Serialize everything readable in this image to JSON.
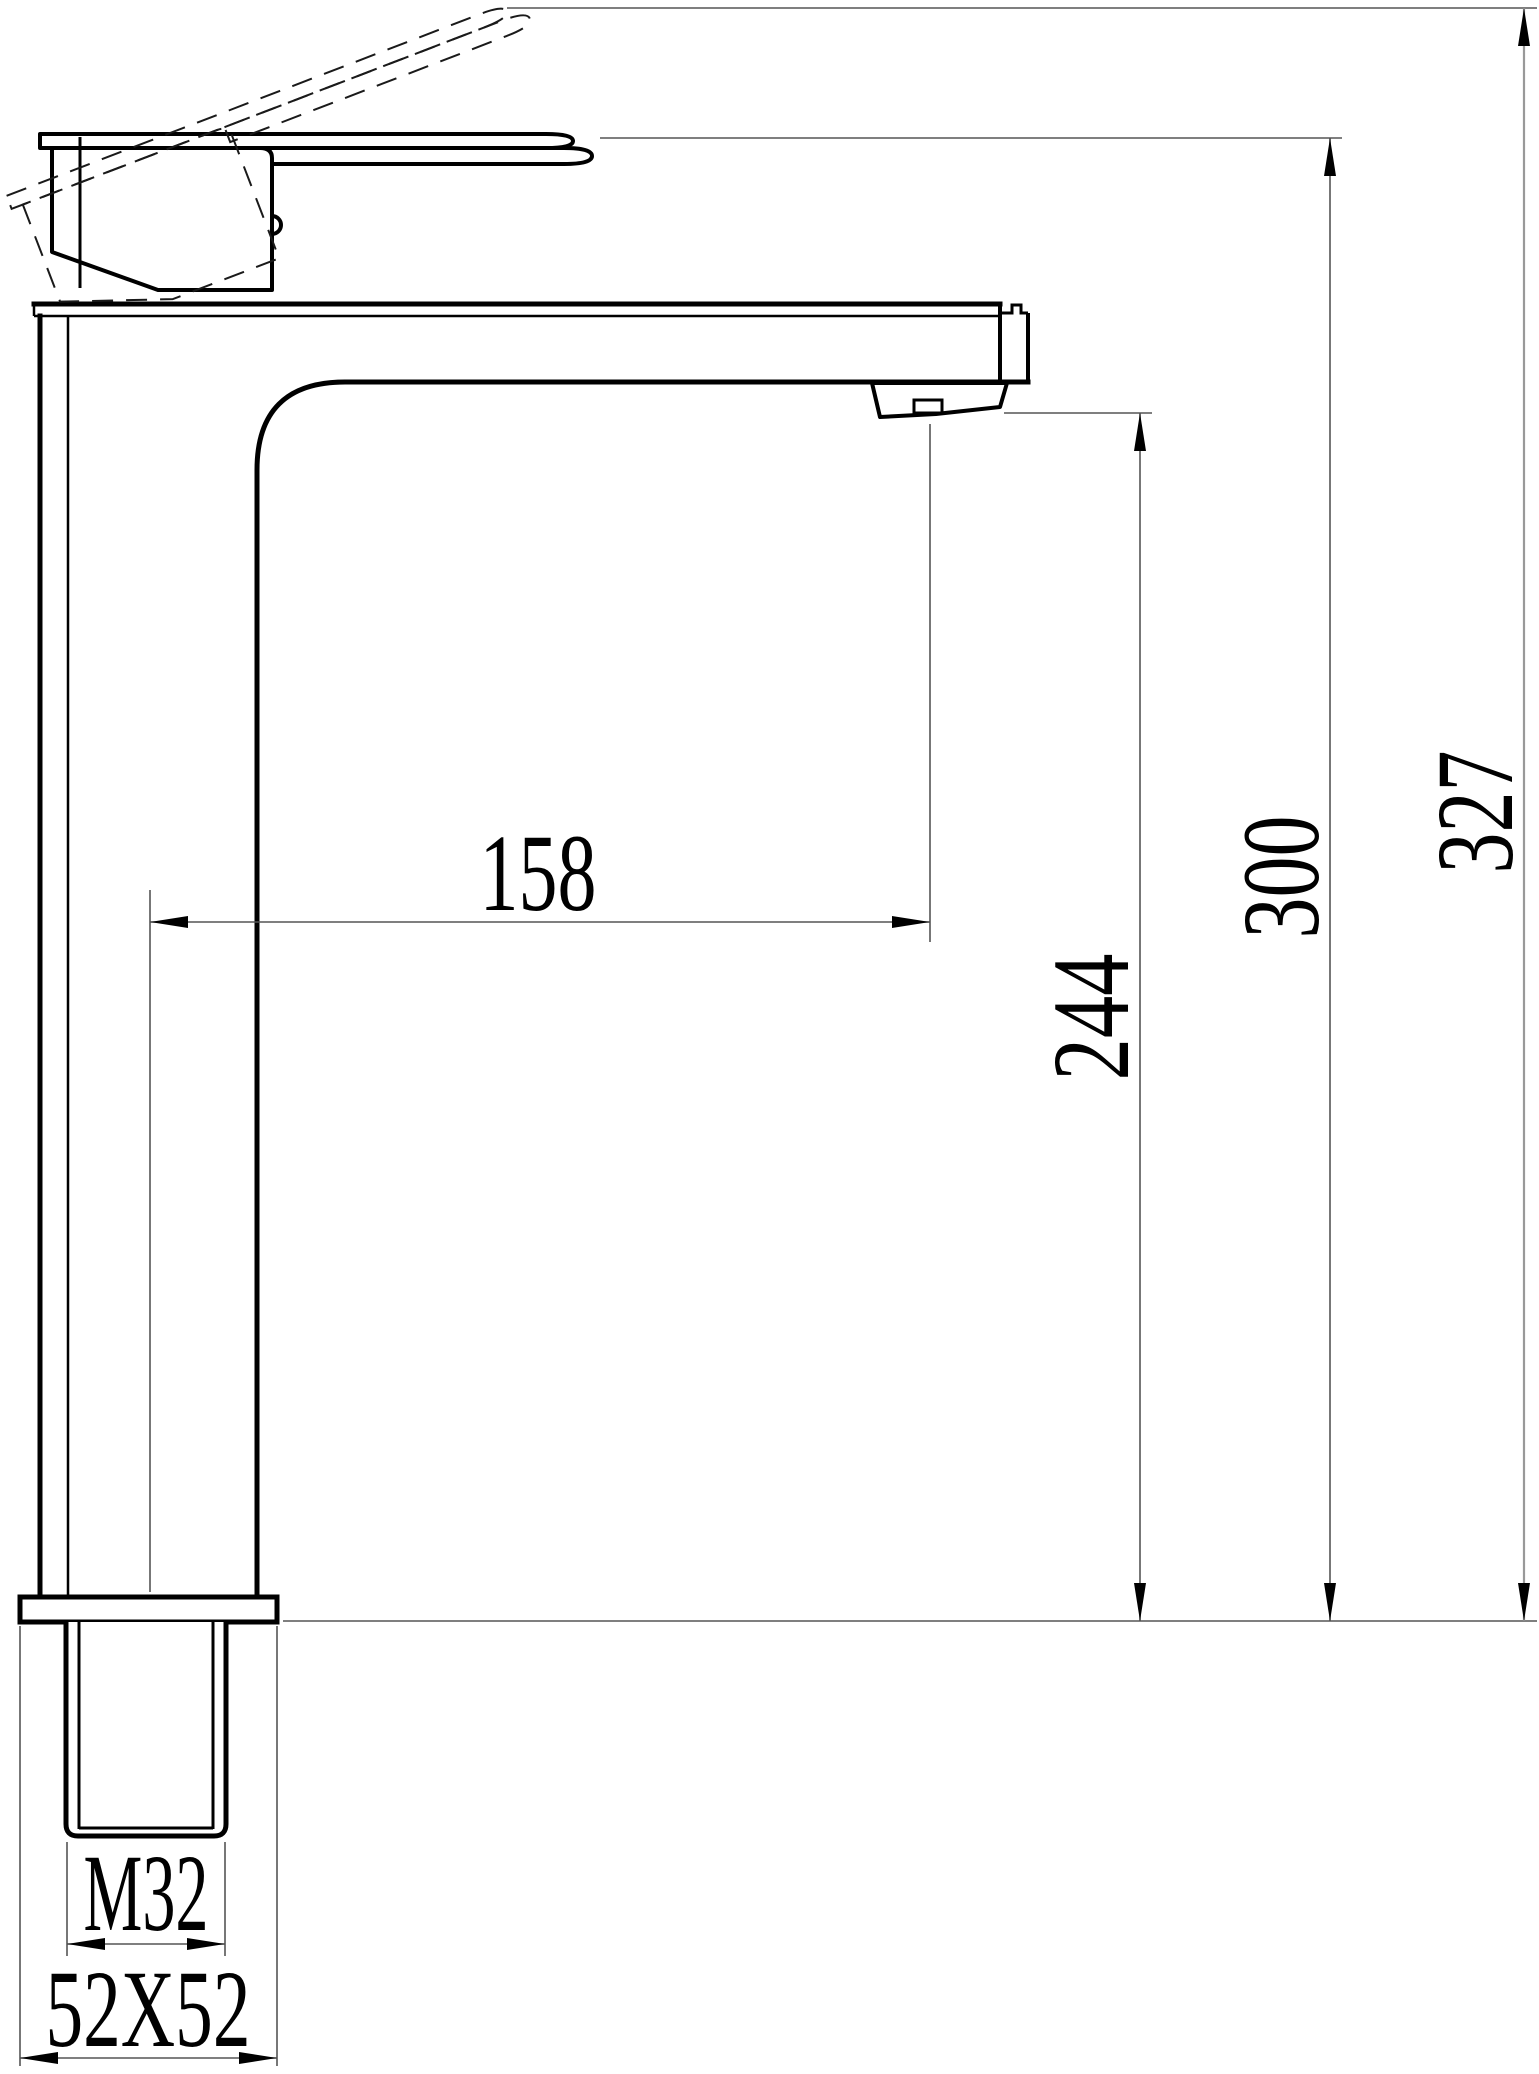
{
  "drawing": {
    "background_color": "#ffffff",
    "object_line_color": "#000000",
    "dimension_line_color": "#555555"
  },
  "dimensions": {
    "spout_reach": "158",
    "spout_outlet_height": "244",
    "body_top_height": "300",
    "overall_height": "327",
    "thread_size": "M32",
    "base_size": "52X52"
  }
}
